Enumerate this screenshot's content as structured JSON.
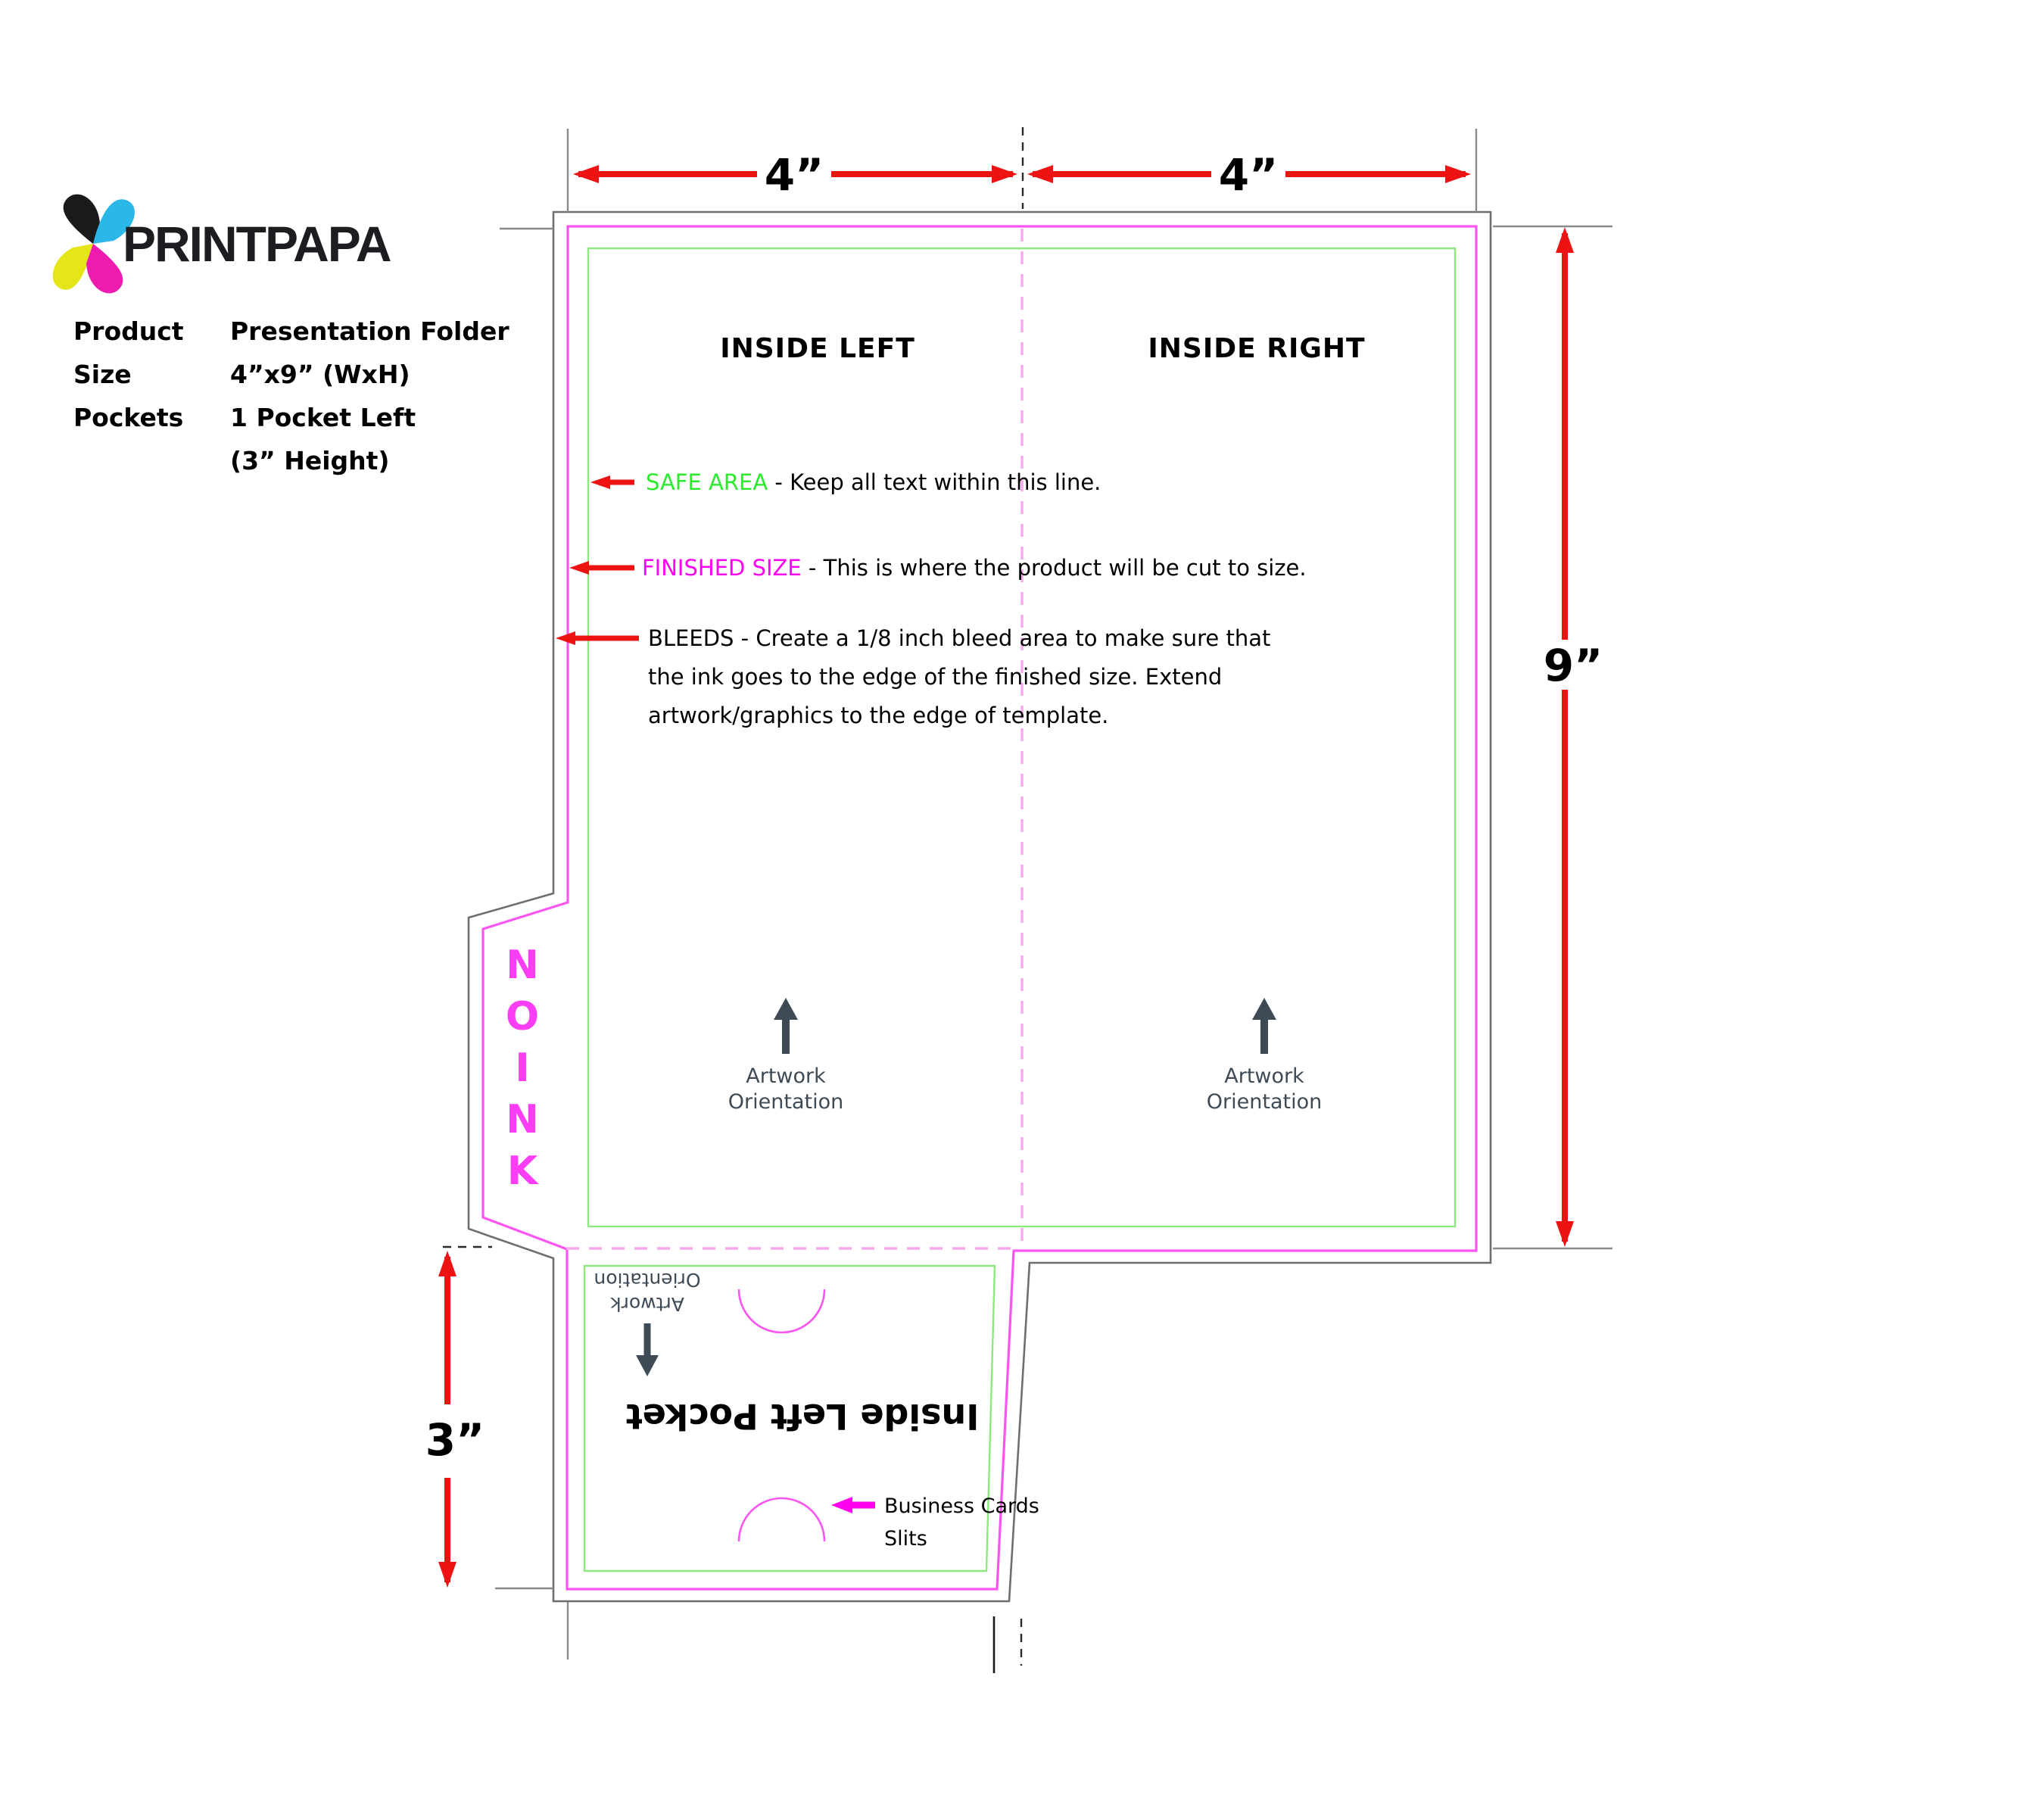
{
  "logo": {
    "brand": "PRINTPAPA"
  },
  "product_info": {
    "rows": [
      {
        "label": "Product",
        "value": "Presentation Folder"
      },
      {
        "label": "Size",
        "value": "4”x9” (WxH)"
      },
      {
        "label": "Pockets",
        "value": "1 Pocket Left"
      },
      {
        "label": "",
        "value": "(3” Height)"
      }
    ]
  },
  "dimensions": {
    "top_left": "4”",
    "top_right": "4”",
    "right": "9”",
    "pocket": "3”"
  },
  "panels": {
    "inside_left": "INSIDE LEFT",
    "inside_right": "INSIDE RIGHT"
  },
  "annotations": {
    "safe_area_label": "SAFE AREA",
    "safe_area_text": " - Keep all text within this line.",
    "finished_label": "FINISHED SIZE",
    "finished_text": " - This is where the product will be cut to size.",
    "bleeds_line1": "BLEEDS - Create a 1/8 inch bleed area to make sure that",
    "bleeds_line2": "the ink goes to the edge of the finished size. Extend",
    "bleeds_line3": "artwork/graphics to the edge of template."
  },
  "no_ink": {
    "letters": [
      "N",
      "O",
      "I",
      "N",
      "K"
    ]
  },
  "artwork_orientation": {
    "line1": "Artwork",
    "line2": "Orientation"
  },
  "pocket": {
    "title": "Inside Left Pocket",
    "slits_line1": "Business Cards",
    "slits_line2": "Slits"
  },
  "colors": {
    "red": "#ee1313",
    "cut": "#fa55f0",
    "cuttxt": "#ff00f0",
    "fold": "#f8a9ef",
    "safe": "#8ee87f",
    "safetxt": "#2eea2e",
    "bleed": "#6e6e6e",
    "ext": "#8a8a8a",
    "slate": "#3e4b57",
    "noink": "#fb3ef5",
    "logo_cyan": "#2bb7e8",
    "logo_magenta": "#ee1cae",
    "logo_yellow": "#e5e619",
    "logo_black": "#1a1a1a"
  }
}
